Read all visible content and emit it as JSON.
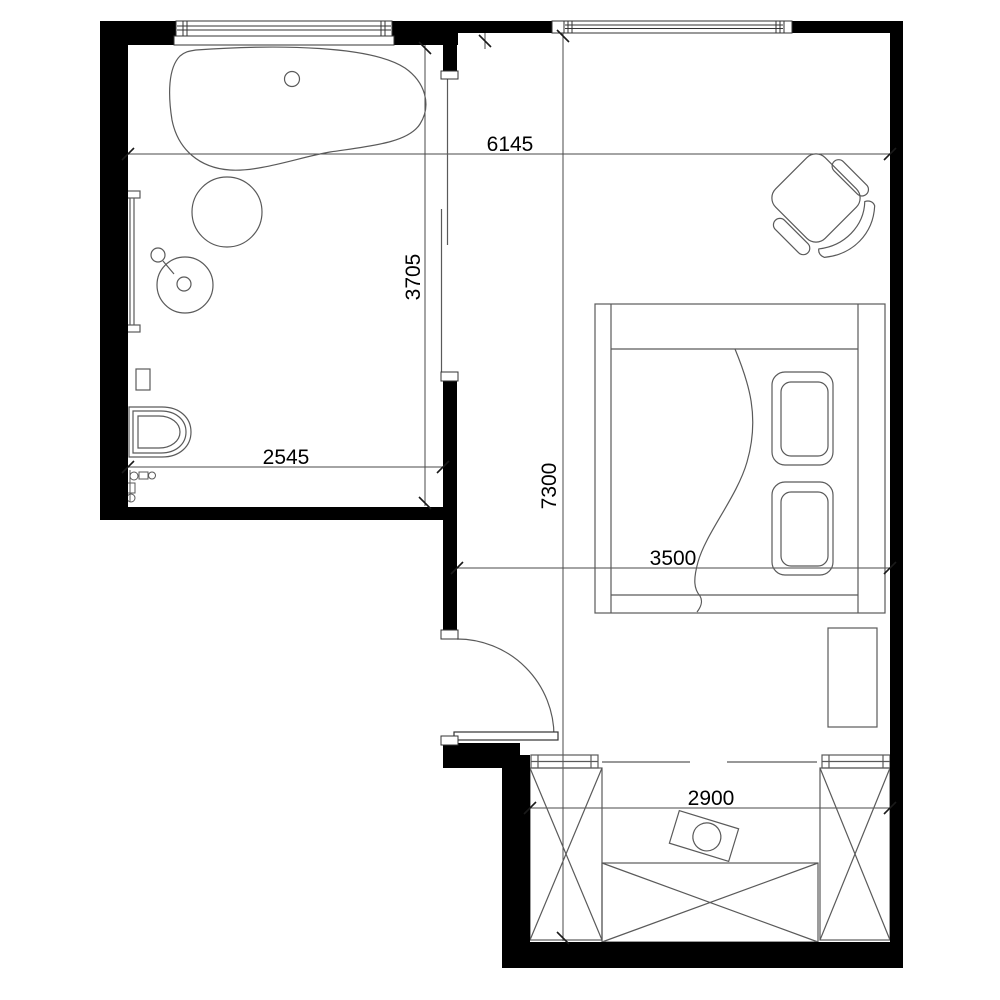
{
  "plan": {
    "type": "apartment-floor-plan",
    "dimensions": {
      "overall_width": "6145",
      "bathroom_depth": "3705",
      "overall_depth": "7300",
      "bathroom_width": "2545",
      "bedroom_width": "3500",
      "closet_width": "2900"
    },
    "colors": {
      "wall": "#000000",
      "furniture_line": "#5a5a5a",
      "dimension_line": "#4a4a4a",
      "background": "#ffffff"
    }
  }
}
